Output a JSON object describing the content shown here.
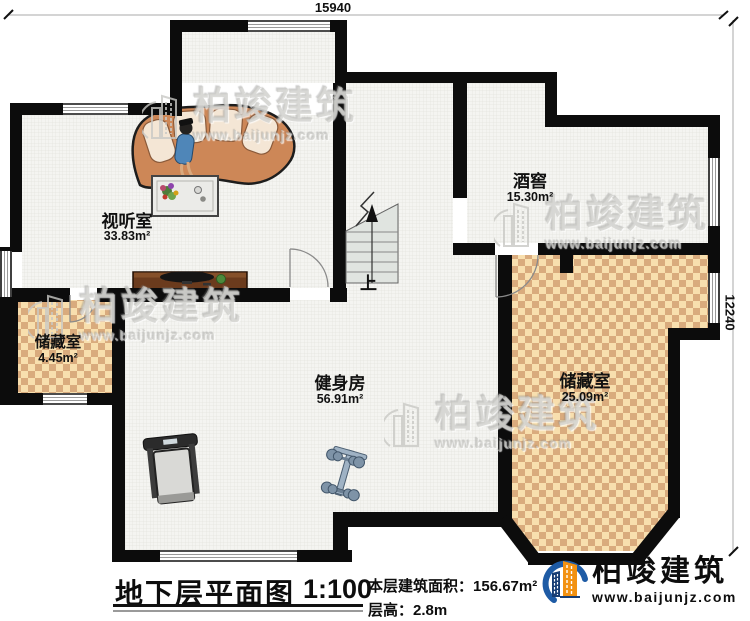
{
  "plan": {
    "title": "地下层平面图",
    "scale": "1:100",
    "dim_top": "15940",
    "dim_right": "12240",
    "stairs_up": "上"
  },
  "rooms": [
    {
      "name": "视听室",
      "area": "33.83m²"
    },
    {
      "name": "酒窖",
      "area": "15.30m²"
    },
    {
      "name": "储藏室",
      "area": "4.45m²"
    },
    {
      "name": "健身房",
      "area": "56.91m²"
    },
    {
      "name": "储藏室",
      "area": "25.09m²"
    }
  ],
  "footer": {
    "area_label": "本层建筑面积：",
    "area_value": "156.67m²",
    "height_label": "层高：",
    "height_value": "2.8m"
  },
  "watermark": {
    "brand": "柏竣建筑",
    "url": "www.baijunjz.com"
  },
  "logo": {
    "brand": "柏竣建筑",
    "url": "www.baijunjz.com"
  },
  "icons": {
    "up_arrow": "↑"
  },
  "colors": {
    "wall": "#0c0c0c",
    "floor": "#f4f4f1",
    "storage_floor_light": "#f8dfae",
    "storage_floor_dark": "#d9ab7d",
    "logo_blue": "#1e5ba5",
    "logo_orange": "#f29111"
  }
}
